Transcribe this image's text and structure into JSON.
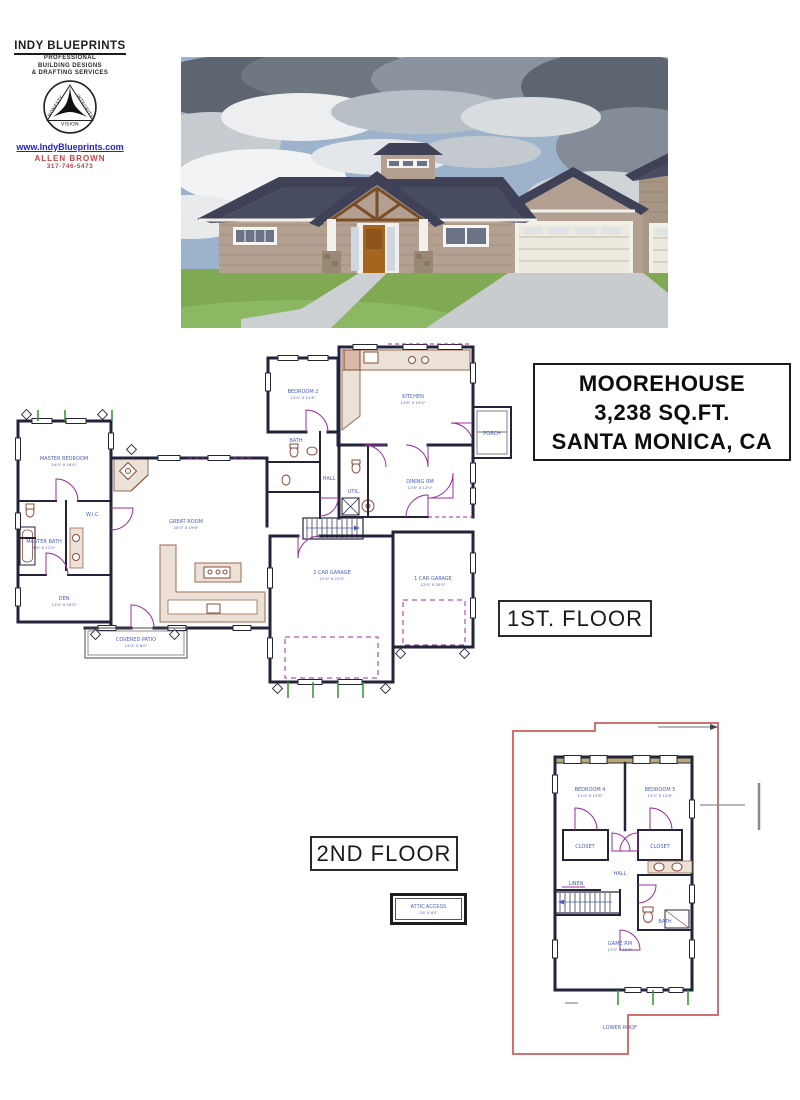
{
  "logo": {
    "company": "INDY BLUEPRINTS",
    "tagline": [
      "PROFESSIONAL",
      "BUILDING DESIGNS",
      "& DRAFTING SERVICES"
    ],
    "emblem": {
      "left": "HONESTY",
      "right": "INTEGRITY",
      "bottom": "VISION"
    },
    "website": "www.IndyBlueprints.com",
    "contact_name": "ALLEN BROWN",
    "phone": "317-746-5473"
  },
  "title_block": {
    "line1": "MOOREHOUSE",
    "line2": "3,238 SQ.FT.",
    "line3": "SANTA MONICA, CA"
  },
  "floor_labels": {
    "first": "1ST. FLOOR",
    "second": "2ND FLOOR"
  },
  "detail_box": {
    "name": "ATTIC ACCESS",
    "dims": "2'6\" X 6'0\""
  },
  "first_floor": {
    "rooms": [
      {
        "name": "MASTER BEDROOM",
        "dims": "14'0\" X 16'0\""
      },
      {
        "name": "MASTER BATH",
        "dims": "9'0\" X 11'0\""
      },
      {
        "name": "W.I.C."
      },
      {
        "name": "DEN",
        "dims": "11'0\" X 10'0\""
      },
      {
        "name": "GREAT ROOM",
        "dims": "20'0\" X 19'6\""
      },
      {
        "name": "BEDROOM 2",
        "dims": "11'0\" X 11'6\""
      },
      {
        "name": "BATH"
      },
      {
        "name": "KITCHEN",
        "dims": "13'6\" X 15'0\""
      },
      {
        "name": "DINING RM",
        "dims": "11'6\" X 12'0\""
      },
      {
        "name": "PORCH"
      },
      {
        "name": "HALL"
      },
      {
        "name": "UTIL."
      },
      {
        "name": "2 CAR GARAGE",
        "dims": "21'4\" X 21'0\""
      },
      {
        "name": "1 CAR GARAGE",
        "dims": "12'0\" X 20'0\""
      },
      {
        "name": "COVERED PATIO",
        "dims": "14'0\" X 8'0\""
      }
    ]
  },
  "second_floor": {
    "rooms": [
      {
        "name": "BEDROOM 4",
        "dims": "11'0\" X 12'6\""
      },
      {
        "name": "BEDROOM 5",
        "dims": "11'0\" X 12'6\""
      },
      {
        "name": "CLOSET"
      },
      {
        "name": "CLOSET"
      },
      {
        "name": "HALL"
      },
      {
        "name": "BATH"
      },
      {
        "name": "LINEN"
      },
      {
        "name": "GAME RM",
        "dims": "17'0\" X 15'6\""
      },
      {
        "name": "LOWER ROOF"
      }
    ]
  },
  "colors": {
    "wall": "#23233a",
    "door_swing": "#9b2d9b",
    "window_tick": "#3a9a3a",
    "counter": "#ece1d6",
    "counter_line": "#9a6a50",
    "room_label": "#4a5fc0",
    "roof_outline": "#d07070",
    "dimension": "#8a8a8a",
    "render_roof": "#3f4257",
    "render_siding": "#b3a090",
    "render_grass": "#7fa953",
    "render_sky": "#9db3cc",
    "link_blue": "#2323cc",
    "name_red": "#cc4444"
  }
}
